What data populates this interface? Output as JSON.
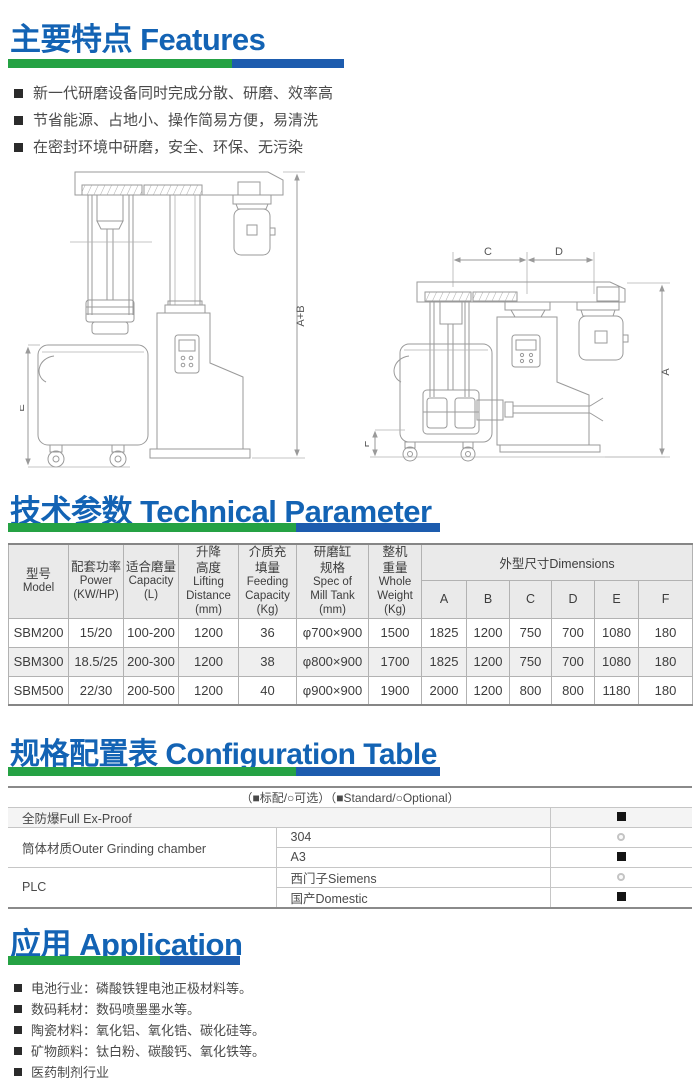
{
  "colors": {
    "header_blue": "#1363b4",
    "bar_green": "#25a244",
    "bar_blue": "#1d5cae",
    "standard_marker": "#141414",
    "optional_marker": "#c4c4c4"
  },
  "sections": {
    "features": {
      "title_zh": "主要特点",
      "title_en": "Features",
      "bullets": [
        "新一代研磨设备同时完成分散、研磨、效率高",
        "节省能源、占地小、操作简易方便，易清洗",
        "在密封环境中研磨，安全、环保、无污染"
      ]
    },
    "technical": {
      "title_zh": "技术参数",
      "title_en": "Technical Parameter",
      "table": {
        "headers": [
          {
            "zh": "型号",
            "en": "Model"
          },
          {
            "zh": "配套功率",
            "en": "Power\n(KW/HP)"
          },
          {
            "zh": "适合磨量",
            "en": "Capacity\n(L)"
          },
          {
            "zh": "升降\n高度",
            "en": "Lifting\nDistance\n(mm)"
          },
          {
            "zh": "介质充\n填量",
            "en": "Feeding\nCapacity\n(Kg)"
          },
          {
            "zh": "研磨缸\n规格",
            "en": "Spec of\nMill Tank\n(mm)"
          },
          {
            "zh": "整机\n重量",
            "en": "Whole\nWeight\n(Kg)"
          }
        ],
        "dimensions": {
          "zh": "外型尺寸",
          "en": "Dimensions",
          "cols": [
            "A",
            "B",
            "C",
            "D",
            "E",
            "F"
          ]
        },
        "rows": [
          [
            "SBM200",
            "15/20",
            "100-200",
            "1200",
            "36",
            "φ700×900",
            "1500",
            "1825",
            "1200",
            "750",
            "700",
            "1080",
            "180"
          ],
          [
            "SBM300",
            "18.5/25",
            "200-300",
            "1200",
            "38",
            "φ800×900",
            "1700",
            "1825",
            "1200",
            "750",
            "700",
            "1080",
            "180"
          ],
          [
            "SBM500",
            "22/30",
            "200-500",
            "1200",
            "40",
            "φ900×900",
            "1900",
            "2000",
            "1200",
            "800",
            "800",
            "1180",
            "180"
          ]
        ]
      }
    },
    "configuration": {
      "title_zh": "规格配置表",
      "title_en": "Configuration Table",
      "legend": "（■标配/○可选）（■Standard/○Optional）",
      "groups": [
        {
          "label": "全防爆Full Ex-Proof",
          "options": [
            {
              "name": "",
              "marker": "standard"
            }
          ]
        },
        {
          "label": "筒体材质Outer Grinding chamber",
          "options": [
            {
              "name": "304",
              "marker": "optional"
            },
            {
              "name": "A3",
              "marker": "standard"
            }
          ]
        },
        {
          "label": "PLC",
          "options": [
            {
              "name": "西门子Siemens",
              "marker": "optional"
            },
            {
              "name": "国产Domestic",
              "marker": "standard"
            }
          ]
        }
      ]
    },
    "application": {
      "title_zh": "应用",
      "title_en": "Application",
      "bullets": [
        "电池行业：磷酸铁锂电池正极材料等。",
        "数码耗材：数码喷墨墨水等。",
        "陶瓷材料：氧化铝、氧化锆、碳化硅等。",
        "矿物颜料：钛白粉、碳酸钙、氧化铁等。",
        "医药制剂行业"
      ]
    }
  },
  "drawings": {
    "left": {
      "dim_total_height": "A+B",
      "dim_tank_height": "E"
    },
    "right": {
      "dim_c": "C",
      "dim_d": "D",
      "dim_height": "A",
      "dim_f": "F"
    }
  }
}
